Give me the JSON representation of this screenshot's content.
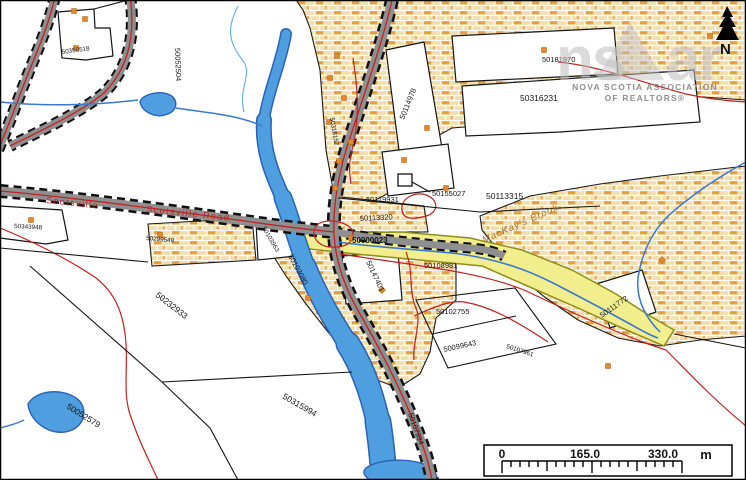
{
  "map": {
    "parcels": [
      {
        "text": "50350518"
      },
      {
        "text": "50052504"
      },
      {
        "text": "50114978"
      },
      {
        "text": "50181970"
      },
      {
        "text": "50316231"
      },
      {
        "text": "50119931"
      },
      {
        "text": "50155027"
      },
      {
        "text": "50113315"
      },
      {
        "text": "50113320"
      },
      {
        "text": "50103080"
      },
      {
        "text": "50147401"
      },
      {
        "text": "50108981"
      },
      {
        "text": "50102755"
      },
      {
        "text": "50099643"
      },
      {
        "text": "50107961"
      },
      {
        "text": "50111772"
      },
      {
        "text": "50232933"
      },
      {
        "text": "50052579"
      },
      {
        "text": "50315994"
      },
      {
        "text": "50343948"
      },
      {
        "text": "50299549"
      },
      {
        "text": "50103963"
      },
      {
        "text": "50107994"
      },
      {
        "text": "50318152"
      }
    ],
    "highlight_parcel": {
      "text": "50000023",
      "color": "#1d7a2a"
    },
    "road_labels": [
      {
        "text": "Scotsville"
      },
      {
        "text": "Scotsville Road"
      }
    ],
    "water_label": "MacKay's Brook",
    "north_label": "N",
    "watermark": {
      "logo_left": "ns",
      "logo_right": "ar",
      "line1": "NOVA SCOTIA ASSOCIATION",
      "line2": "OF REALTORS®"
    },
    "scale_bar": {
      "zero": "0",
      "mid": "165.0",
      "max": "330.0",
      "unit": "m"
    }
  },
  "colors": {
    "water_fill": "#4f9fe0",
    "water_edge": "#2a62b4",
    "brick_base": "#f3dfae",
    "brick_accent": "#e2942f",
    "road_fill": "#8f8f8f",
    "highlight_fill": "#f2ee8e",
    "red_boundary": "#c22121",
    "marker_orange": "#e2892b",
    "green_label": "#1d7a2a"
  }
}
